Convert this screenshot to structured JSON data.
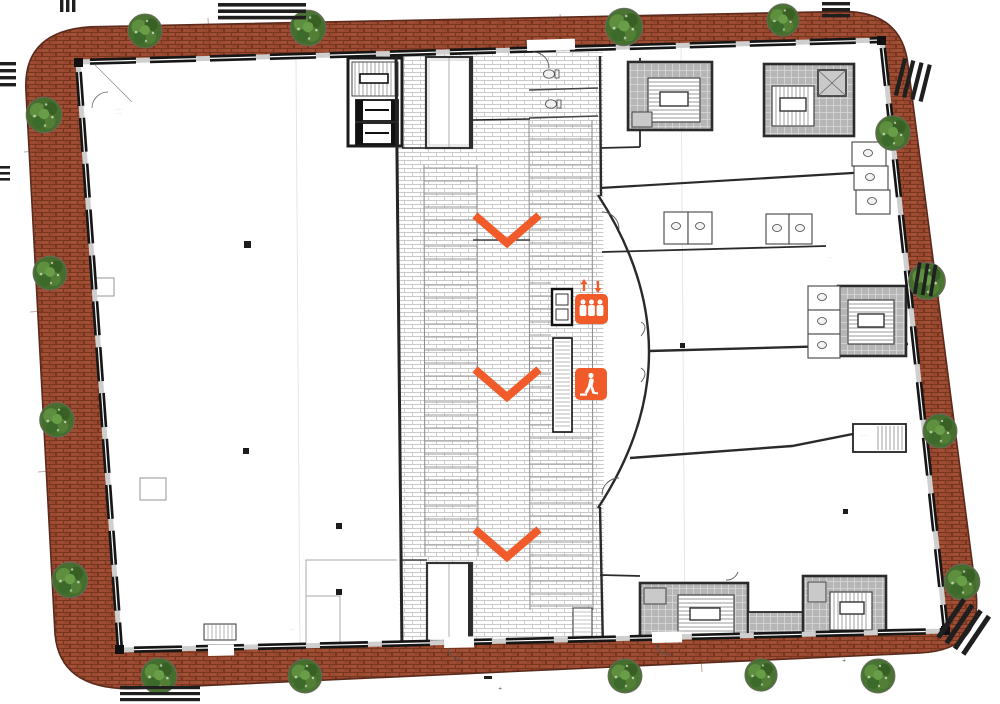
{
  "plan": {
    "type_label": "architectural-floor-plan",
    "colors": {
      "pavement_brick": "#9e4b33",
      "pavement_mortar": "#77371f",
      "pavement_edge": "#5a2a1c",
      "wall_dark": "#1c1c1c",
      "wall_pier": "#cfcfcf",
      "hatch_line": "#c9c9c9",
      "core_fill": "#b6b6b6",
      "core_grid": "#d9d9d9",
      "accent_orange": "#f15a29",
      "tree_green": "#44702e",
      "road_mark": "#1f1f1f"
    },
    "wayfinding": {
      "down_chevron_count": 3,
      "elevator_icon": "elevator-people-icon",
      "escalator_icon": "escalator-person-icon"
    },
    "counts": {
      "trees": 17,
      "crosswalk_marks": 10,
      "service_cores": 6
    },
    "micro_labels": {
      "0": "····· ··",
      "1": "·· ····",
      "2": "···· ···",
      "3": "··· ··",
      "4": "·····",
      "5": "··· ···",
      "6": "·· ··",
      "7": "·····",
      "8": "+",
      "9": "+"
    }
  }
}
